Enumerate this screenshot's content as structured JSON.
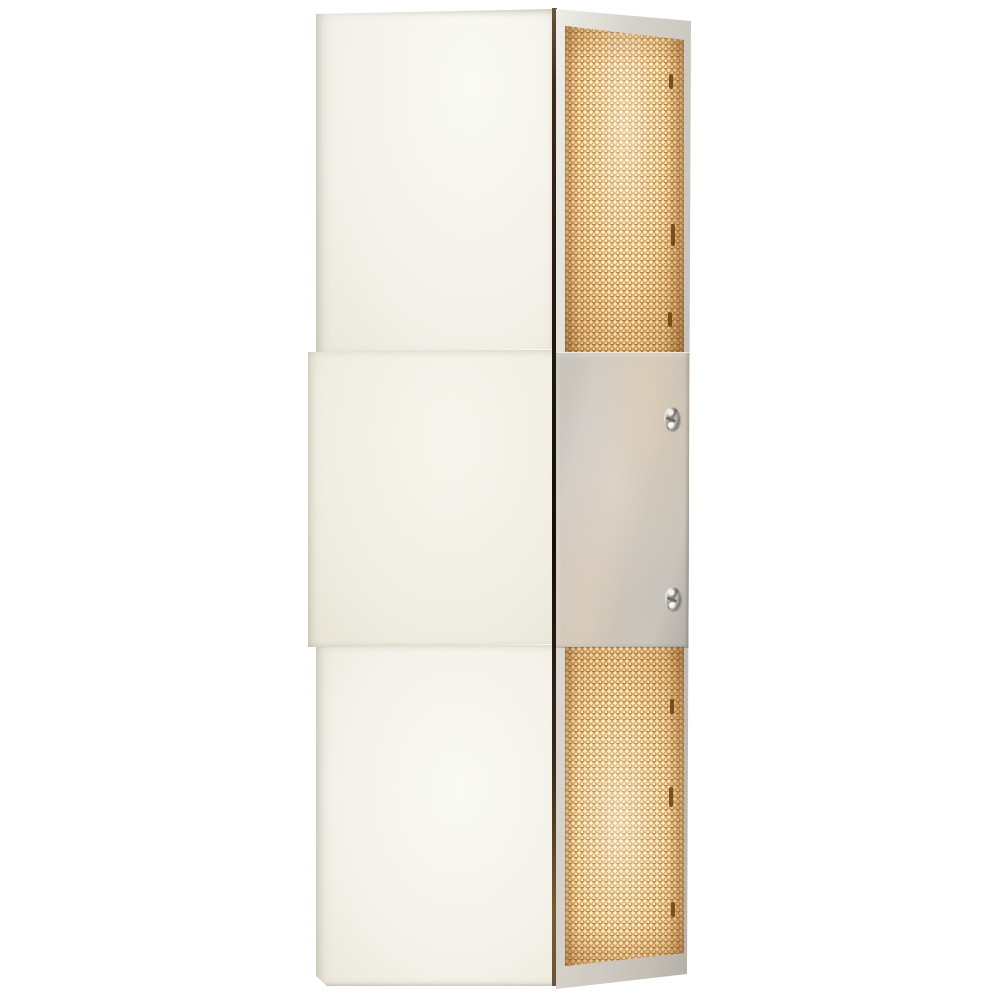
{
  "scene": {
    "description": "Studio product photograph of a rectangular wall sconce: polished white metal front in three stacked sections, with an illuminated gold woven-mesh side screen at top and bottom and a brushed nickel mounting plate fastened by two screws in the middle of the side, on a plain white background",
    "background_color": "#ffffff"
  },
  "parts": [
    "top diffuser panel",
    "middle band panel",
    "bottom diffuser panel",
    "dark corner seam",
    "gold mesh side screen (top)",
    "brushed nickel side mounting plate",
    "mounting screw (upper)",
    "mounting screw (lower)",
    "gold mesh side screen (bottom)"
  ],
  "colors": {
    "background_color": "#ffffff",
    "front_face": "#f3f1e9",
    "front_face_bright": "#fafaf4",
    "front_face_shadow": "#d9d6c8",
    "band_face": "#f0eee3",
    "nickel_frame": "#d6d2ca",
    "nickel_frame_bright": "#efede8",
    "nickel_frame_dark": "#b3afa6",
    "plate_base": "#c2bdb4",
    "plate_shadow": "#a19c93",
    "plate_warm": "#d8cabb",
    "mesh_base": "#dca253",
    "mesh_bright": "#fff3d8",
    "mesh_amber": "#c9811f",
    "mesh_dark": "#8a5512",
    "seam_dark": "#241a10",
    "seam_brown": "#6b5335",
    "screw_bright": "#f2f0ea",
    "screw_dark": "#6e6a62"
  }
}
